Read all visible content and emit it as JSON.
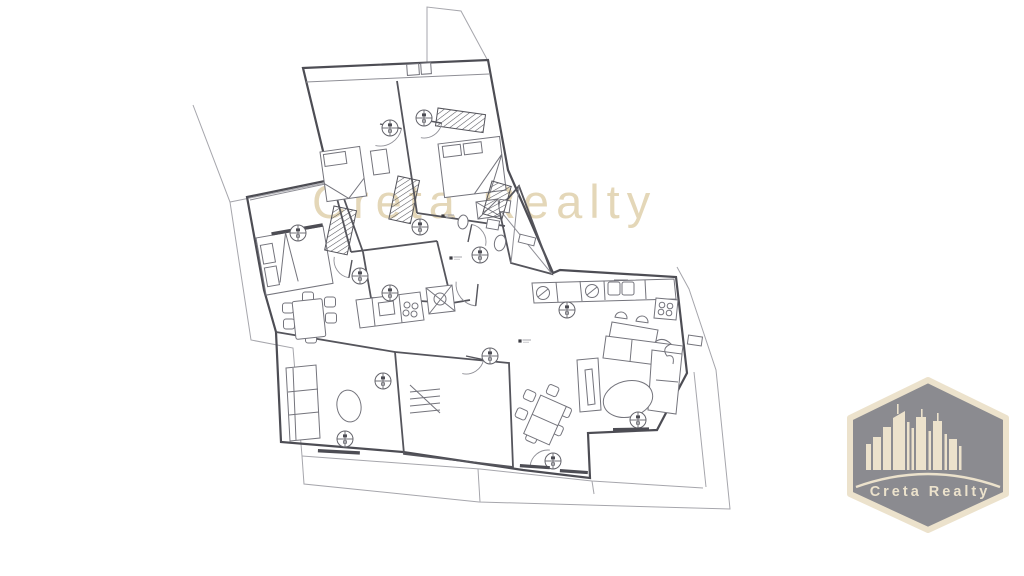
{
  "page": {
    "type": "real-estate-floor-plan-image",
    "background": "#ffffff"
  },
  "watermark": {
    "text": "Creta Realty",
    "color": "#e4d7b8"
  },
  "logo": {
    "label": "Creta Realty",
    "shape": "hexagon-badge",
    "hex_fill": "#8b8b90",
    "cream": "#ece2cc",
    "icon": "city-skyline-icon"
  },
  "floor_plan": {
    "kind": "apartment-architectural-plan",
    "orientation": "rotated-irregular",
    "rooms": [
      "bedroom-top-left",
      "bedroom-top-right",
      "bedroom-left",
      "bathroom-center",
      "entry-hall-shaft",
      "kitchen-left",
      "kitchen-right",
      "dining-area-left",
      "dining-area-center",
      "living-room",
      "storage-stairs-room",
      "terrace"
    ],
    "furniture_symbols": [
      "single-bed",
      "double-bed",
      "double-bed",
      "wardrobe-hatched",
      "wardrobe-hatched",
      "wardrobe-hatched",
      "wardrobe-hatched",
      "dining-table-6-chairs",
      "dining-table-6-chairs",
      "kitchen-counter-sink-stove",
      "kitchen-counter-sink-stove",
      "breakfast-bar-2-stools",
      "corner-sofa",
      "wall-sofa",
      "tv-bench",
      "oval-rug",
      "oval-rug",
      "toilet",
      "shower",
      "washing-machine",
      "staircase"
    ],
    "symbols": {
      "ceiling_fan_count": 13,
      "door_swing_count": 7,
      "level_marker_count": 3
    }
  }
}
